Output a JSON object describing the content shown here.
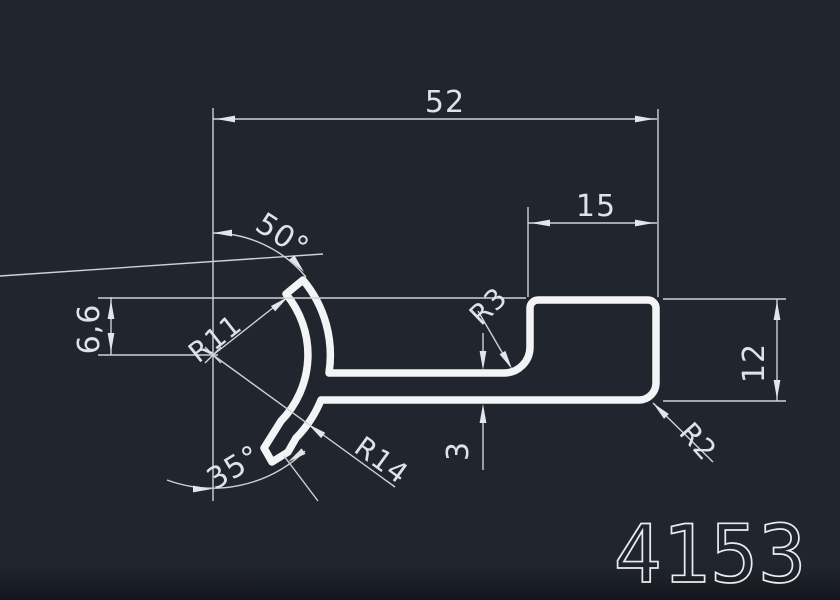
{
  "drawing": {
    "part_number": "4153",
    "dimensions": {
      "overall_width": "52",
      "block_width": "15",
      "offset_height": "6,6",
      "block_height": "12",
      "wall_thickness": "3",
      "angle_top": "50°",
      "angle_bottom": "35°",
      "radius_inner": "R11",
      "radius_outer": "R14",
      "radius_fillet": "R3",
      "radius_corner": "R2"
    },
    "colors": {
      "background": "#21252d",
      "lines": "#cfd2d8",
      "profile": "#f3f4f6",
      "text": "#dfe2e6"
    }
  }
}
